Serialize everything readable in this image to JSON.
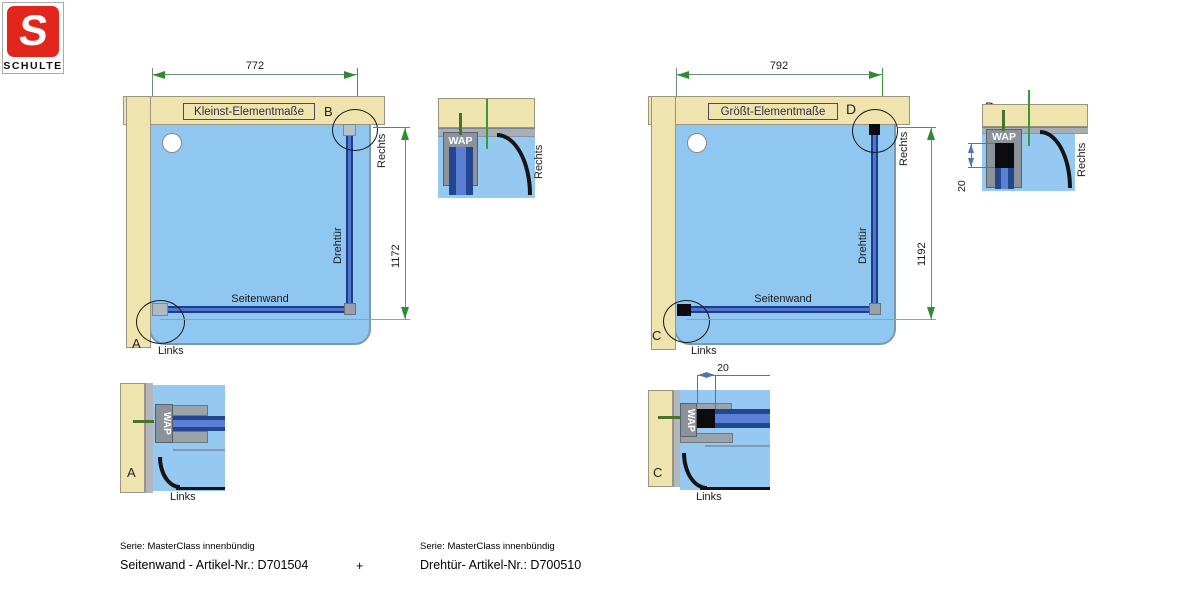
{
  "logo": {
    "letter": "S",
    "brand": "SCHULTE"
  },
  "left_diagram": {
    "title": "Kleinst-Elementmaße",
    "width_dim": "772",
    "height_dim": "1172",
    "door_label": "Drehtür",
    "wall_label": "Seitenwand",
    "rechts": "Rechts",
    "links": "Links",
    "marker_top": "B",
    "marker_bottom": "A"
  },
  "right_diagram": {
    "title": "Größt-Elementmaße",
    "width_dim": "792",
    "height_dim": "1192",
    "door_label": "Drehtür",
    "wall_label": "Seitenwand",
    "rechts": "Rechts",
    "links": "Links",
    "marker_top": "D",
    "marker_bottom": "C"
  },
  "detail_b": {
    "label": "B",
    "profile": "WAP",
    "side": "Rechts"
  },
  "detail_d": {
    "label": "D",
    "profile": "WAP",
    "side": "Rechts",
    "dim": "20"
  },
  "detail_a": {
    "label": "A",
    "profile": "WAP",
    "side": "Links"
  },
  "detail_c": {
    "label": "C",
    "profile": "WAP",
    "side": "Links",
    "dim": "20"
  },
  "footer": {
    "left_serie": "Serie: MasterClass innenbündig",
    "left_article": "Seitenwand - Artikel-Nr.: D701504",
    "plus": "+",
    "right_serie": "Serie: MasterClass innenbündig",
    "right_article": "Drehtür- Artikel-Nr.: D700510"
  },
  "colors": {
    "wall_beige": "#f0e4ae",
    "tray_blue": "#90c7f0",
    "profile_navy": "#1e3c8c",
    "dim_green": "#2e8b2e",
    "detail_dim_blue": "#4a7aaa",
    "logo_red": "#e2261d"
  }
}
